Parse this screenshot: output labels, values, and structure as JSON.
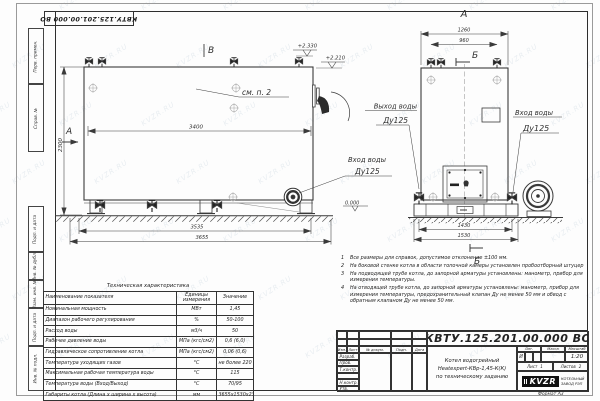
{
  "watermark": "KVZR.RU",
  "frame": {
    "stamp_rotated": "КВТУ.125.201.00.000  ВО",
    "side_labels": [
      "Перв. примен.",
      "Справ. №",
      "Подп. и дата",
      "Инв. № дубл.",
      "Взам. инв. №",
      "Подп. и дата",
      "Инв. № подл."
    ]
  },
  "views": {
    "main": {
      "marker_b": "В",
      "marker_a": "А",
      "see_note": "см. п. 2",
      "dim_inner_width": "3400",
      "dim_height": "2300",
      "dim_base": "3535",
      "dim_total": "3655",
      "elev_top": "+2.330",
      "elev_mid": "+2.210",
      "elev_ground": "0.000",
      "inlet_line1": "Вход воды",
      "inlet_line2": "Ду125"
    },
    "front": {
      "title": "А",
      "marker_section": "Б",
      "dim_top_outer": "1260",
      "dim_top_inner": "960",
      "dim_bottom_inner": "1430",
      "dim_bottom_outer": "1530",
      "outlet_line1": "Выход воды",
      "outlet_line2": "Ду125",
      "inlet_line1": "Вход воды",
      "inlet_line2": "Ду125"
    }
  },
  "notes": [
    {
      "num": "1",
      "text": "Все размеры для справок, допустимое отклонение ±100 мм."
    },
    {
      "num": "2",
      "text": "На боковой стенке котла в области топочной камеры установлен пробоотборный штуцер"
    },
    {
      "num": "3",
      "text": "На  подводящей трубе котла, до запорной арматуры установлены:  манометр, прибор для измерения температуры."
    },
    {
      "num": "4",
      "text": "На отводящей трубе котла, до запорной арматуры установлены:  манометр, прибор для измерения температуры, предохранительный клапан Ду не менее 50 мм и обвод с обратным клапаном Ду не менее 50 мм."
    }
  ],
  "tech_table": {
    "title": "Техническая характеристика",
    "headers": [
      "Наименование показателя",
      "Единицы измерения",
      "Значение"
    ],
    "rows": [
      [
        "Номинальная мощность",
        "МВт",
        "1,45"
      ],
      [
        "Диапазон рабочего регулирования",
        "%",
        "50-100"
      ],
      [
        "Расход воды",
        "м3/ч",
        "50"
      ],
      [
        "Рабочее давление воды",
        "МПа (кгс/см2)",
        "0,6 (6,0)"
      ],
      [
        "Гидравлическое сопротивление котла",
        "МПа (кгс/см2)",
        "0,06 (0,6)"
      ],
      [
        "Температура уходящих газов",
        "°С",
        "не более 220"
      ],
      [
        "Максимальная рабочая температура воды",
        "°С",
        "115"
      ],
      [
        "Температура воды (Вход/Выход)",
        "°С",
        "70/95"
      ],
      [
        "Габариты котла (Длина х ширина х высота)",
        "мм",
        "3655х1530х2330"
      ]
    ]
  },
  "title_block": {
    "designation": "КВТУ.125.201.00.000  ВО",
    "name_line1": "Котел водогрейный",
    "name_line2": "Heatexpert-КВр-1,45-К(К)",
    "name_line3": "по техническому заданию",
    "col_izm": "Изм.",
    "col_list": "Лист",
    "col_doc": "№ докум.",
    "col_podp": "Подп.",
    "col_data": "Дата",
    "row_razrab": "Разраб.",
    "row_prov": "Пров.",
    "row_tkontr": "Т.контр.",
    "row_nkontr": "Н.контр.",
    "row_utv": "Утв.",
    "lit_header": "Лит.",
    "mass_header": "Масса",
    "scale_header": "Масштаб",
    "lit_value": "И",
    "scale_value": "1:20",
    "sheet_label": "Лист",
    "sheet_value": "1",
    "sheets_label": "Листов",
    "sheets_value": "2",
    "logo_text": "KVZR",
    "company_line1": "КОТЕЛЬНЫЙ",
    "company_line2": "ЗАВОД РЭП",
    "format_text": "Формат  А3"
  },
  "colors": {
    "line": "#3a3a3a",
    "light_mark": "#a6a6a6"
  }
}
